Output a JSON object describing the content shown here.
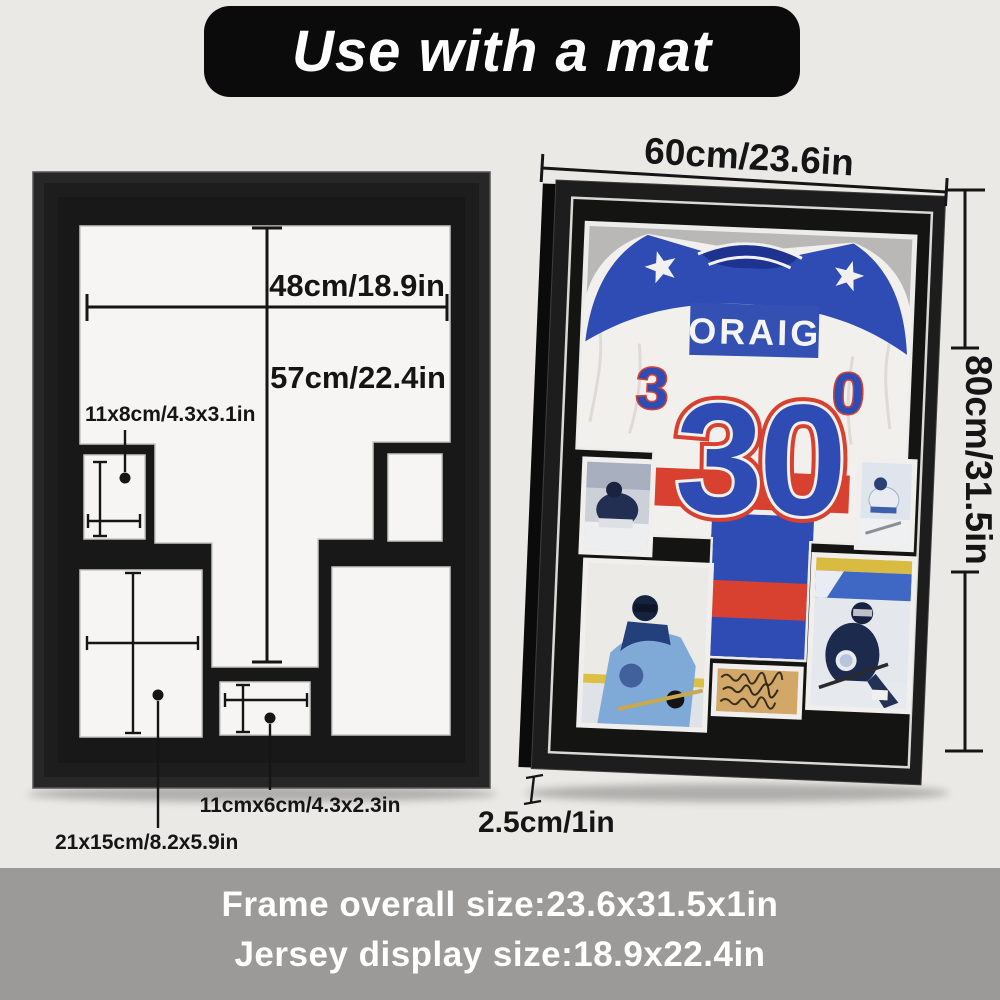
{
  "banner": {
    "title": "Use with a mat"
  },
  "left_diagram": {
    "width_label": "48cm/18.9in",
    "height_label": "57cm/22.4in",
    "opening_small_top_left_label": "11x8cm/4.3x3.1in",
    "opening_large_left_label": "21x15cm/8.2x5.9in",
    "opening_small_bottom_label": "11cmx6cm/4.3x2.3in"
  },
  "right_frame": {
    "width_label": "60cm/23.6in",
    "height_label": "80cm/31.5in",
    "depth_label": "2.5cm/1in",
    "jersey": {
      "name": "ORAIG",
      "number": "30",
      "sleeve_left_number": "3",
      "sleeve_right_number": "0"
    }
  },
  "footer": {
    "line1": "Frame overall size:23.6x31.5x1in",
    "line2": "Jersey display size:18.9x22.4in"
  },
  "colors": {
    "background": "#ebe9e5",
    "banner_bg": "#0b0b0b",
    "footer_bg": "#9b9a98",
    "mat_black": "#181818",
    "opening_white": "#f6f5f3",
    "jersey_blue": "#2e4cb3",
    "jersey_red": "#d8402f",
    "jersey_navy": "#1e338f",
    "backdrop_gray": "#b9b8b6"
  }
}
